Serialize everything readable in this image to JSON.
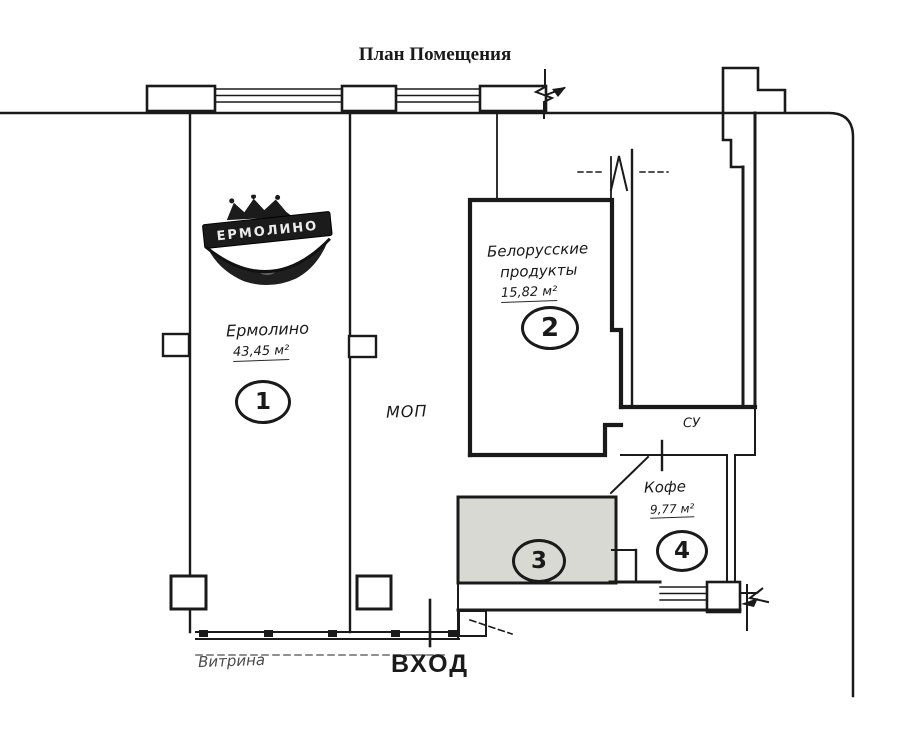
{
  "title": "План Помещения",
  "logo": {
    "text": "ЕРМОЛИНО"
  },
  "rooms": {
    "r1": {
      "number": "1",
      "name": "Ермолино",
      "area": "43,45 м²"
    },
    "r2": {
      "number": "2",
      "name_line1": "Белорусские",
      "name_line2": "продукты",
      "area": "15,82 м²"
    },
    "r3": {
      "number": "3"
    },
    "r4": {
      "number": "4",
      "name": "Кофе",
      "area": "9,77 м²"
    }
  },
  "labels": {
    "common_area": "МОП",
    "sanitary_unit": "СУ",
    "showcase": "Витрина",
    "entrance": "ВХОД"
  },
  "colors": {
    "ink": "#1a1a1a",
    "room3_fill": "#d9d9d3"
  }
}
